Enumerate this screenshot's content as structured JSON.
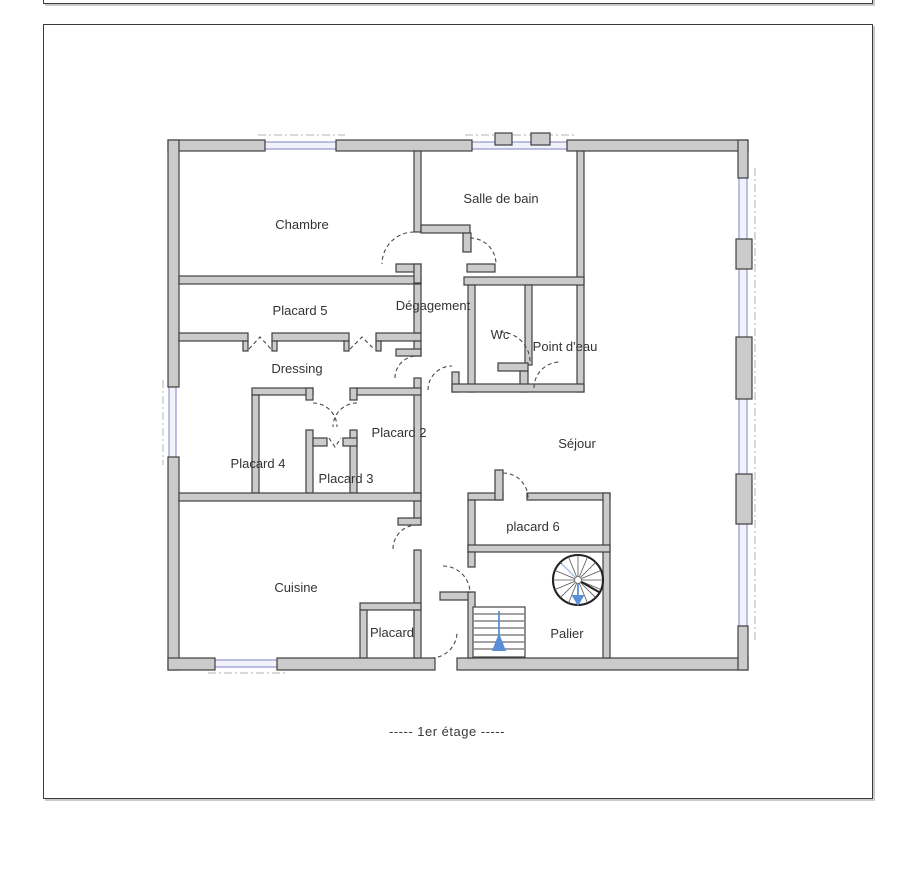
{
  "plan": {
    "caption": "-----  1er étage  -----",
    "rooms": [
      {
        "id": "chambre",
        "label": "Chambre"
      },
      {
        "id": "salle-de-bain",
        "label": "Salle de bain"
      },
      {
        "id": "placard-5",
        "label": "Placard 5"
      },
      {
        "id": "degagement",
        "label": "Dégagement"
      },
      {
        "id": "wc",
        "label": "Wc"
      },
      {
        "id": "point-d-eau",
        "label": "Point d'eau"
      },
      {
        "id": "dressing",
        "label": "Dressing"
      },
      {
        "id": "placard-2",
        "label": "Placard 2"
      },
      {
        "id": "placard-4",
        "label": "Placard 4"
      },
      {
        "id": "placard-3",
        "label": "Placard 3"
      },
      {
        "id": "sejour",
        "label": "Séjour"
      },
      {
        "id": "placard-6",
        "label": "placard 6"
      },
      {
        "id": "cuisine",
        "label": "Cuisine"
      },
      {
        "id": "placard",
        "label": "Placard"
      },
      {
        "id": "palier",
        "label": "Palier"
      }
    ],
    "symbols": {
      "spiral_stair": "spiral-staircase",
      "straight_stair": "straight-staircase",
      "stair_arrows": "direction-arrows"
    }
  },
  "colors": {
    "wall_fill": "#cbcbcb",
    "wall_stroke": "#3f3f3f",
    "window_blue": "#7d81c8",
    "arrow_blue": "#5b8ed8",
    "text": "#333333"
  }
}
